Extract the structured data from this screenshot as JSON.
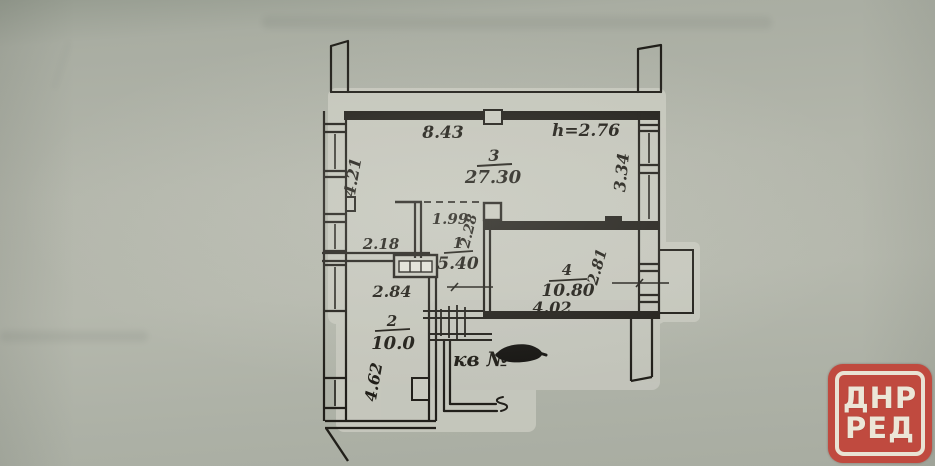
{
  "document": {
    "kind_label": "apartment floor plan scan"
  },
  "plan": {
    "ceiling_height": "h=2.76",
    "apartment_label": "кв №",
    "rooms": {
      "r1": {
        "number": "1",
        "area": "5.40"
      },
      "r2": {
        "number": "2",
        "area": "10.0"
      },
      "r3": {
        "number": "3",
        "area": "27.30"
      },
      "r4": {
        "number": "4",
        "area": "10.80"
      }
    },
    "dims": {
      "top_width": "8.43",
      "left_upper": "4.21",
      "right_upper": "3.34",
      "r1_width": "1.99",
      "r1_depth": "2.28",
      "r2_top": "2.18",
      "r2_width": "2.84",
      "r2_left": "4.62",
      "r4_width": "4.02",
      "r4_right": "2.81"
    }
  },
  "stamp": {
    "line1": "ДНР",
    "line2": "РЕД",
    "background": "#c04a3f",
    "text_color": "#ece6d7"
  },
  "colors": {
    "paper": "#b3b6ab",
    "paper_light": "#c9cac0",
    "ink": "#211f1a"
  }
}
